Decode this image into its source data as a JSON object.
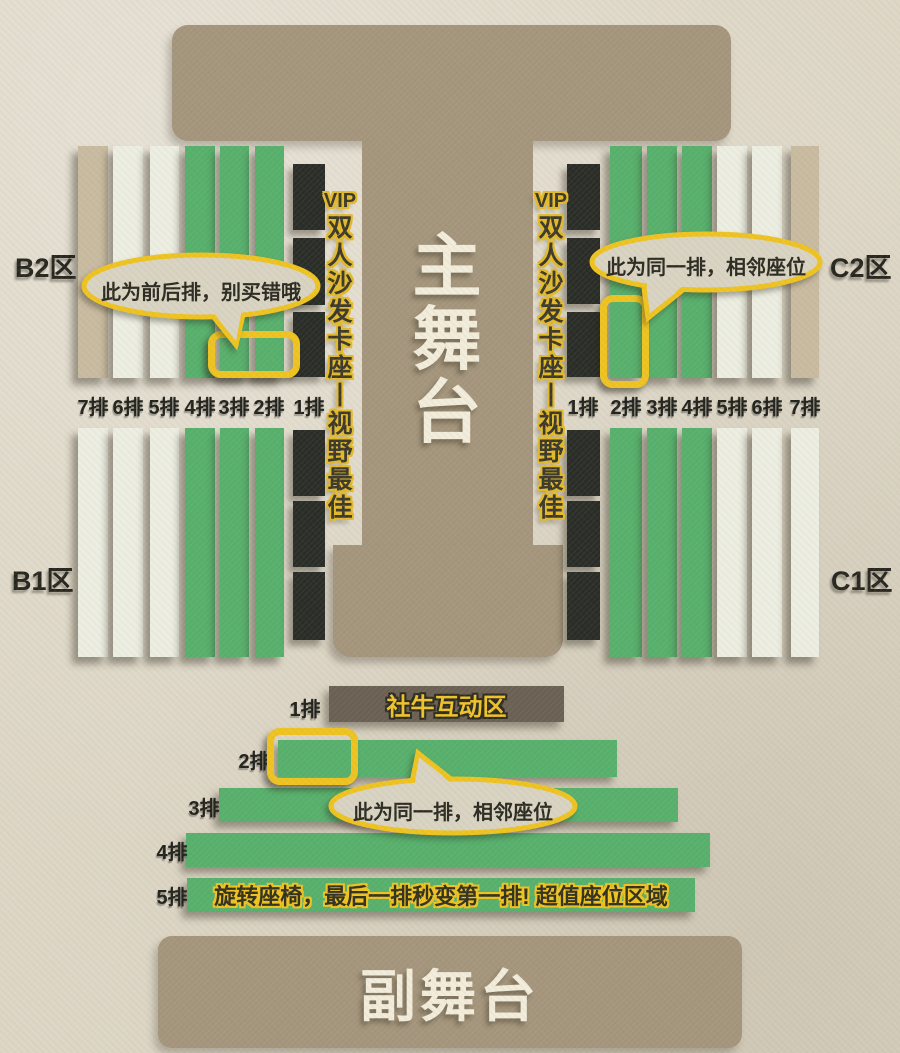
{
  "colors": {
    "background": "#ddd6c5",
    "stage": "#a4957c",
    "seat_green": "#57b06c",
    "seat_white": "#edeee2",
    "seat_tan": "#c9bba0",
    "seat_dark": "#2a2d27",
    "interactive_bar": "#6a6053",
    "highlight_yellow": "#eec320",
    "bubble_fill": "#d9d3c2",
    "ink": "#26261f",
    "stage_text": "#f2ecdb"
  },
  "stage": {
    "main": "主舞台",
    "secondary": "副舞台"
  },
  "vip": {
    "label": "VIP",
    "desc": "双人沙发卡座丨视野最佳"
  },
  "zones": {
    "b2": "B2区",
    "b1": "B1区",
    "c2": "C2区",
    "c1": "C1区",
    "a_label": "A区",
    "a_note": "（旋转座椅）"
  },
  "rows": {
    "left": [
      "7排",
      "6排",
      "5排",
      "4排",
      "3排",
      "2排",
      "1排"
    ],
    "right": [
      "1排",
      "2排",
      "3排",
      "4排",
      "5排",
      "6排",
      "7排"
    ],
    "floor": [
      "1排",
      "2排",
      "3排",
      "4排",
      "5排"
    ]
  },
  "floor": {
    "interactive_zone": "社牛互动区",
    "row5_note": "旋转座椅，最后一排秒变第一排! 超值座位区域"
  },
  "bubbles": {
    "front_back": "此为前后排，别买错哦",
    "same_row": "此为同一排，相邻座位",
    "same_row_floor": "此为同一排，相邻座位"
  }
}
